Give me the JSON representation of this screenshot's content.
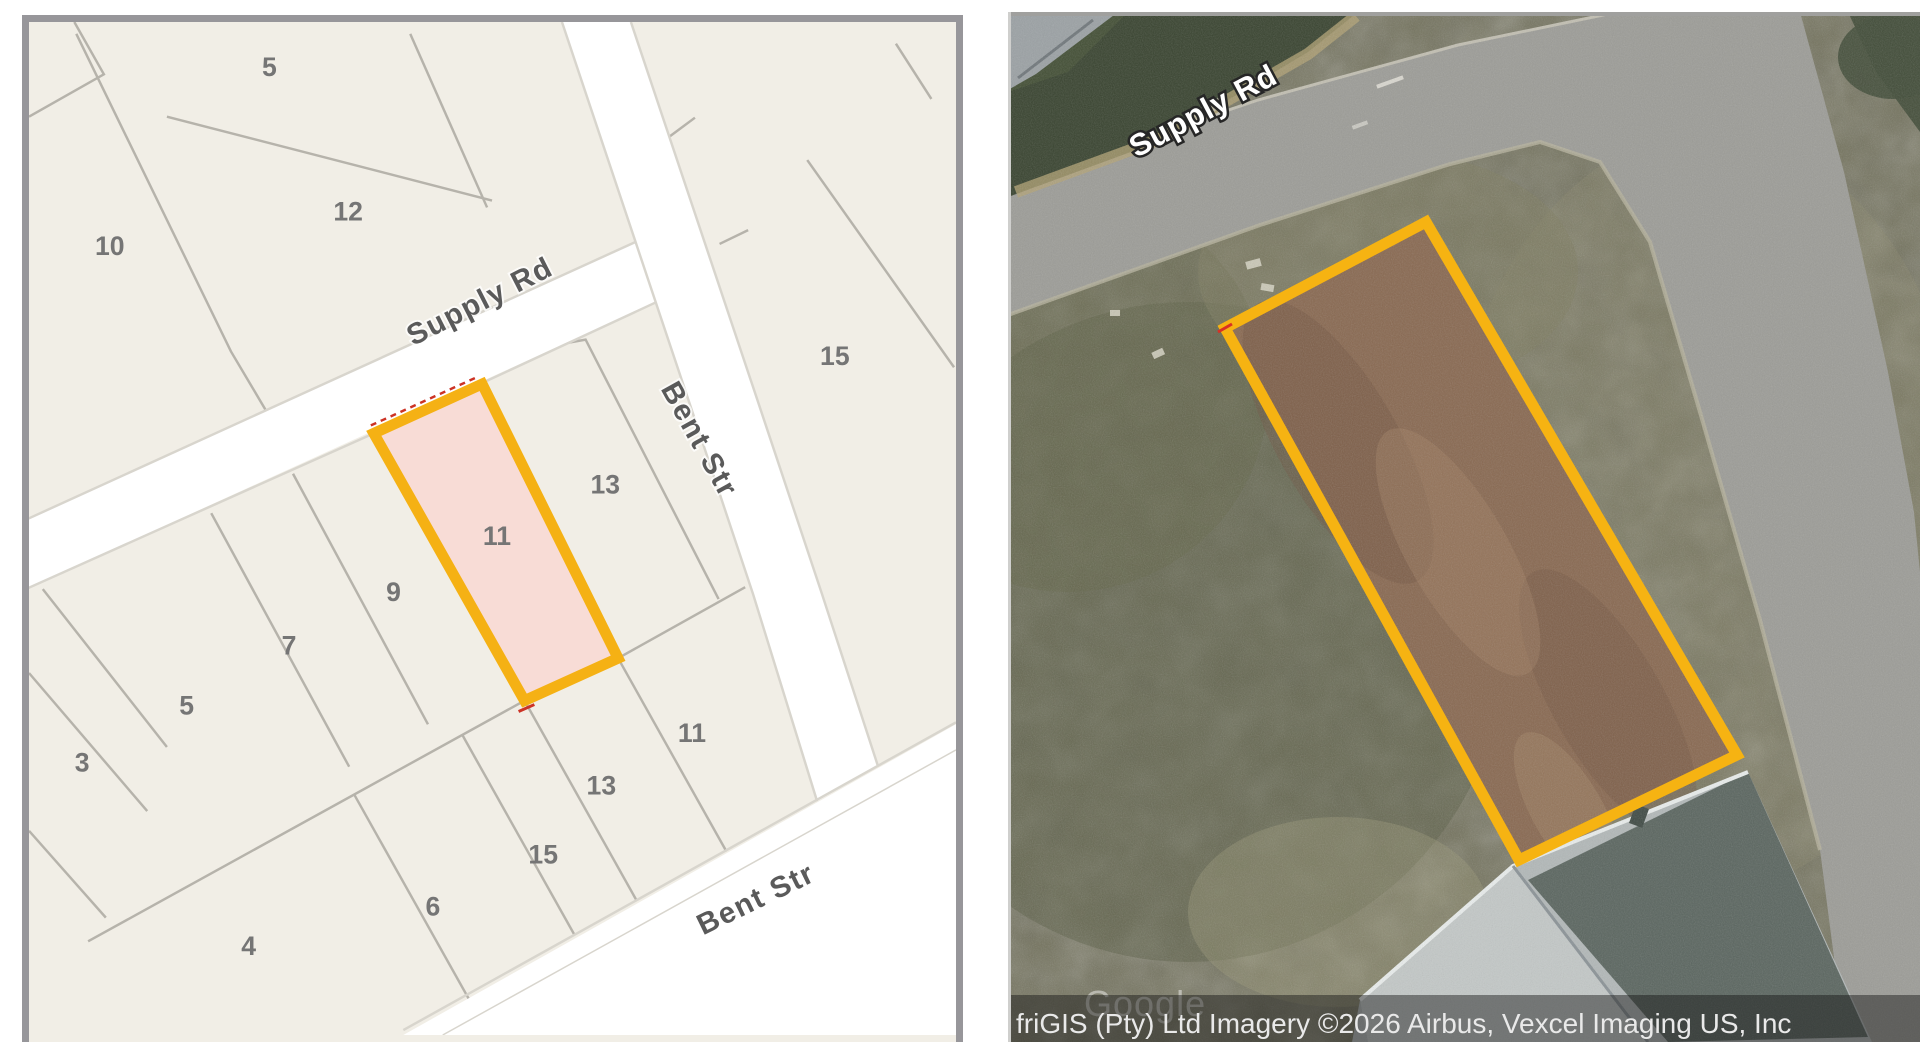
{
  "left_map": {
    "description": "cadastral parcel map",
    "highlighted_parcel": {
      "number": "11",
      "fill_color": "#f8dcd6",
      "outline_color": "#f5b114",
      "red_boundary_color": "#cc3325"
    },
    "parcel_labels": [
      {
        "text": "5",
        "x": 244,
        "y": 55
      },
      {
        "text": "12",
        "x": 324,
        "y": 201
      },
      {
        "text": "10",
        "x": 82,
        "y": 236
      },
      {
        "text": "15",
        "x": 818,
        "y": 348
      },
      {
        "text": "13",
        "x": 585,
        "y": 478
      },
      {
        "text": "11",
        "x": 475,
        "y": 530
      },
      {
        "text": "9",
        "x": 370,
        "y": 587
      },
      {
        "text": "7",
        "x": 264,
        "y": 641
      },
      {
        "text": "5",
        "x": 160,
        "y": 702
      },
      {
        "text": "3",
        "x": 54,
        "y": 760
      },
      {
        "text": "11",
        "x": 673,
        "y": 730
      },
      {
        "text": "13",
        "x": 581,
        "y": 783
      },
      {
        "text": "15",
        "x": 522,
        "y": 853
      },
      {
        "text": "6",
        "x": 410,
        "y": 906
      },
      {
        "text": "4",
        "x": 223,
        "y": 946
      }
    ],
    "street_labels": [
      {
        "text": "Supply Rd",
        "x": 462,
        "y": 292,
        "rotate": -27
      },
      {
        "text": "Bent Str",
        "x": 672,
        "y": 428,
        "rotate": 61
      },
      {
        "text": "Bent Str",
        "x": 742,
        "y": 898,
        "rotate": -26
      }
    ]
  },
  "satellite": {
    "street_label": "Supply Rd",
    "watermark": "Google",
    "attribution": "friGIS (Pty) Ltd Imagery ©2026 Airbus, Vexcel Imaging US, Inc",
    "highlighted_lot": {
      "outline_color": "#f6b312",
      "ground_color": "#886850",
      "description": "cleared dirt lot outlined in orange fronting Supply Rd"
    }
  },
  "colors": {
    "map_background": "#f1eee6",
    "map_parcel_line": "#b6b3ab",
    "map_road_fill": "#ffffff",
    "map_road_casing": "#d8d5cd",
    "frame_border": "#97969a",
    "grass": "#71705a",
    "road_gray": "#9c9c97",
    "hedge_green": "#38432f",
    "roof_gray": "#b2b8b8"
  }
}
